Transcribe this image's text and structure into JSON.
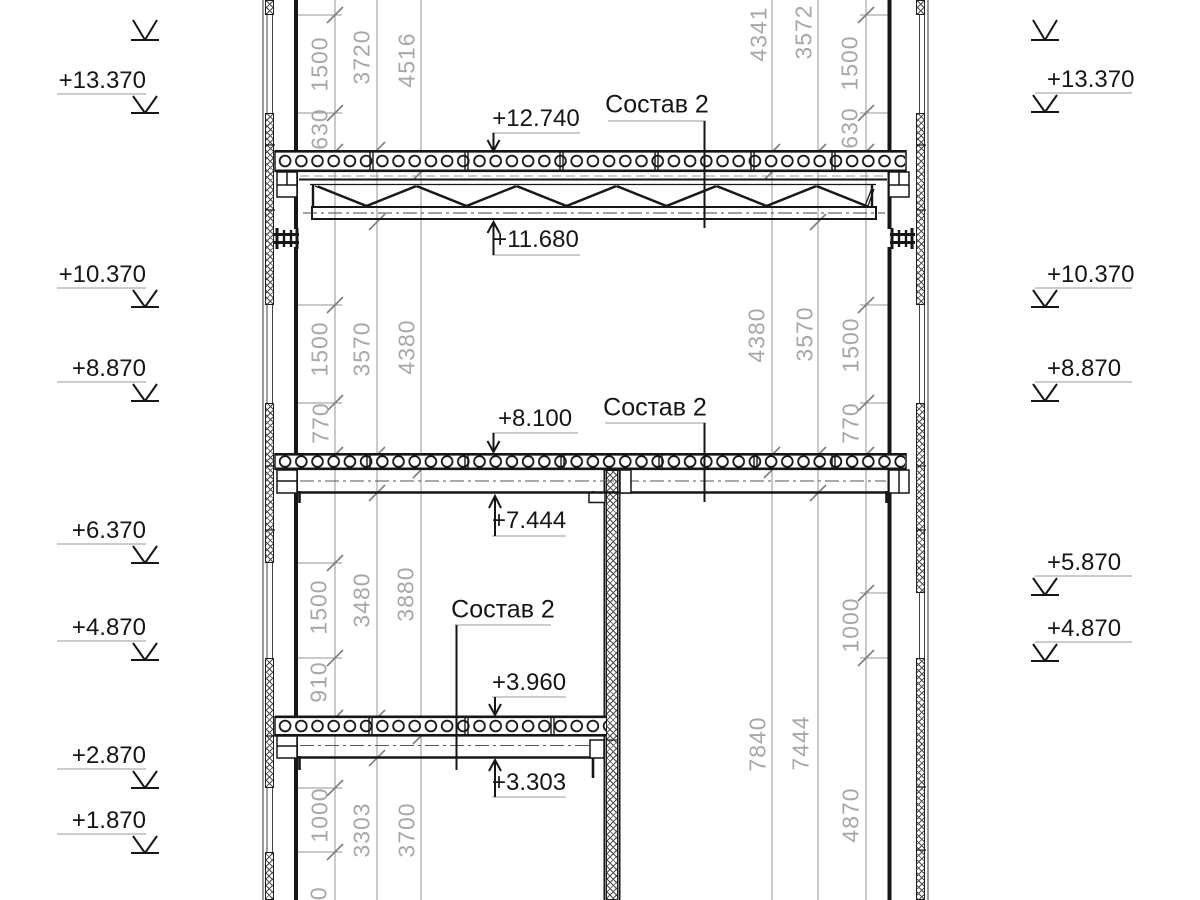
{
  "drawing": {
    "composition_labels": [
      "Состав 2",
      "Состав 2",
      "Состав 2"
    ],
    "level_labels": [
      "+12.740",
      "+11.680",
      "+8.100",
      "+7.444",
      "+3.960",
      "+3.303"
    ],
    "elevation_marks_left": [
      "+13.370",
      "+10.370",
      "+8.870",
      "+6.370",
      "+4.870",
      "+2.870",
      "+1.870"
    ],
    "elevation_marks_right": [
      "+13.370",
      "+10.370",
      "+8.870",
      "+5.870",
      "+4.870"
    ],
    "dimensions": {
      "left_chain": [
        "1500",
        "630",
        "1500",
        "770",
        "1500",
        "910",
        "1000",
        "770"
      ],
      "left_story": [
        "3720",
        "3570",
        "3480",
        "3303"
      ],
      "left_clear": [
        "4516",
        "4380",
        "3880",
        "3700"
      ],
      "right_story": [
        "4341",
        "4380",
        "7840"
      ],
      "right_clear": [
        "3572",
        "3570",
        "7444"
      ],
      "right_chain": [
        "1500",
        "630",
        "1500",
        "770",
        "1000",
        "4870"
      ]
    },
    "colors": {
      "line": "#1b1b1b",
      "dim_line": "#949494",
      "dim_text": "#a8a8a8"
    }
  }
}
